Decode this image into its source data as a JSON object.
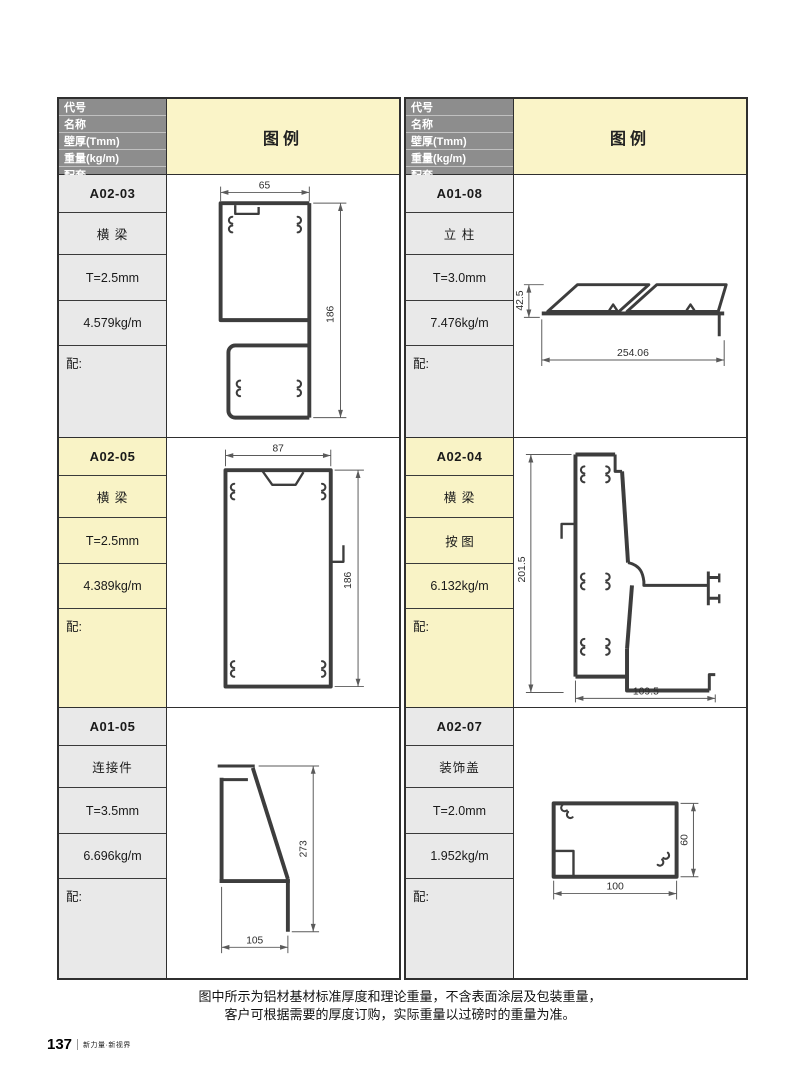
{
  "page": {
    "number": "137",
    "brand": "新力量·新视界"
  },
  "note": {
    "line1": "图中所示为铝材基材标准厚度和理论重量，不含表面涂层及包装重量，",
    "line2": "客户可根据需要的厚度订购，实际重量以过磅时的重量为准。"
  },
  "header": {
    "field_labels": [
      "代号",
      "名称",
      "壁厚(Tmm)",
      "重量(kg/m)",
      "配套"
    ],
    "legend_label": "图例"
  },
  "entries": {
    "left": [
      {
        "code": "A02-03",
        "name": "横 梁",
        "thickness": "T=2.5mm",
        "weight": "4.579kg/m",
        "match": "配:",
        "width_dim": "65",
        "height_dim": "186"
      },
      {
        "code": "A02-05",
        "name": "横 梁",
        "thickness": "T=2.5mm",
        "weight": "4.389kg/m",
        "match": "配:",
        "width_dim": "87",
        "height_dim": "186"
      },
      {
        "code": "A01-05",
        "name": "连接件",
        "thickness": "T=3.5mm",
        "weight": "6.696kg/m",
        "match": "配:",
        "width_dim": "105",
        "height_dim": "273"
      }
    ],
    "right": [
      {
        "code": "A01-08",
        "name": "立 柱",
        "thickness": "T=3.0mm",
        "weight": "7.476kg/m",
        "match": "配:",
        "width_dim": "254.06",
        "height_dim": "42.5"
      },
      {
        "code": "A02-04",
        "name": "横 梁",
        "thickness": "按 图",
        "weight": "6.132kg/m",
        "match": "配:",
        "width_dim": "109.5",
        "height_dim": "201.5"
      },
      {
        "code": "A02-07",
        "name": "装饰盖",
        "thickness": "T=2.0mm",
        "weight": "1.952kg/m",
        "match": "配:",
        "width_dim": "100",
        "height_dim": "60"
      }
    ]
  },
  "colors": {
    "header_bg": "#8d8d8d",
    "legend_bg": "#faf4c8",
    "highlight_bg": "#f9f3c6",
    "label_bg": "#e9e9e9",
    "drawing_line": "#3d3d3d"
  }
}
